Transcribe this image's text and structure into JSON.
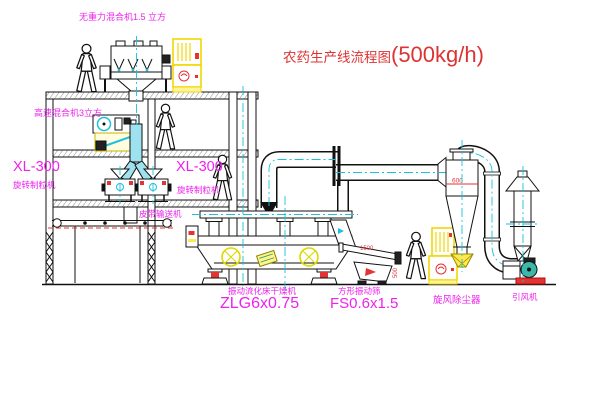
{
  "diagram": {
    "title": {
      "text": "农药生产线流程图",
      "capacity": "(500kg/h)"
    },
    "equipment_labels": {
      "gravity_mixer": "无重力混合机1.5 立方",
      "high_speed_mixer": "高速混合机3立方",
      "granulator_left": {
        "model": "XL-300",
        "name": "旋转制粒机"
      },
      "granulator_right": {
        "model": "XL-300",
        "name": "旋转制粒机"
      },
      "belt_conveyor": "皮带输送机",
      "dryer": {
        "name": "振动流化床干燥机",
        "model": "ZLG6x0.75"
      },
      "screen": {
        "name": "方形振动筛",
        "model": "FS0.6x1.5"
      },
      "cyclone": "旋风除尘器",
      "fan": "引风机"
    },
    "dimensions": {
      "screen_length": "1500",
      "screen_width": "500",
      "cyclone_inlet": "600"
    },
    "colors": {
      "label_magenta": "#ee22ee",
      "title_red": "#dd3333",
      "centerline_cyan": "#17c3dc",
      "cabinet_yellow": "#f0d800",
      "motor_symbol_yellow": "#ddd800",
      "valve_yellow": "#ffe94d",
      "fan_teal": "#3bb8a8",
      "spring_red": "#e33333"
    }
  }
}
